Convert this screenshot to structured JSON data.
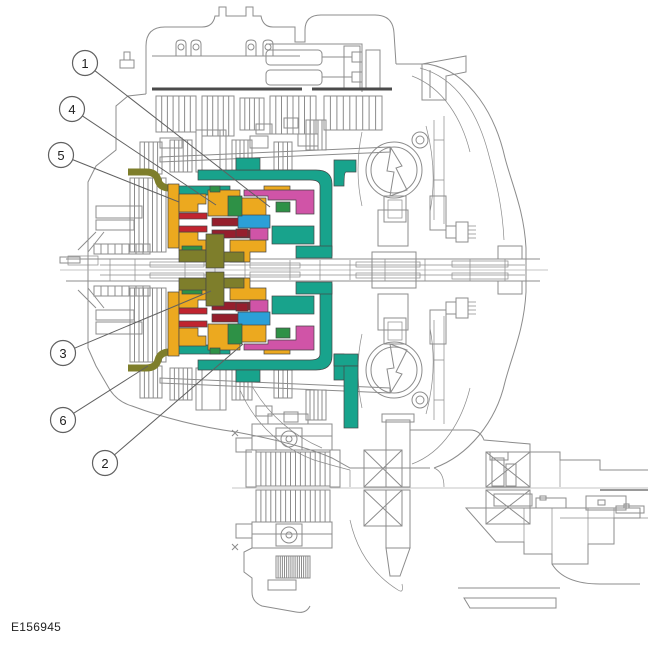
{
  "figure": {
    "code": "E156945"
  },
  "palette": {
    "line": "#8c8c8c",
    "dark": "#4a4a4a",
    "edge": "#454545",
    "teal": "#18A38C",
    "yellow": "#ECA91F",
    "magenta": "#D054A7",
    "red": "#C0242F",
    "crimson": "#951F2D",
    "blue": "#2BA0D8",
    "green": "#2E9146",
    "olive": "#7E7E2B",
    "callout_stroke": "#606060",
    "callout_text": "#1f1f1f"
  },
  "callouts": [
    {
      "label": "1",
      "cx": 85,
      "cy": 63,
      "tx": 270,
      "ty": 207
    },
    {
      "label": "2",
      "cx": 105,
      "cy": 463,
      "tx": 243,
      "ty": 344
    },
    {
      "label": "3",
      "cx": 63,
      "cy": 353,
      "tx": 211,
      "ty": 291
    },
    {
      "label": "4",
      "cx": 72,
      "cy": 109,
      "tx": 216,
      "ty": 205
    },
    {
      "label": "5",
      "cx": 61,
      "cy": 155,
      "tx": 179,
      "ty": 202
    },
    {
      "label": "6",
      "cx": 63,
      "cy": 420,
      "tx": 148,
      "ty": 366
    }
  ]
}
